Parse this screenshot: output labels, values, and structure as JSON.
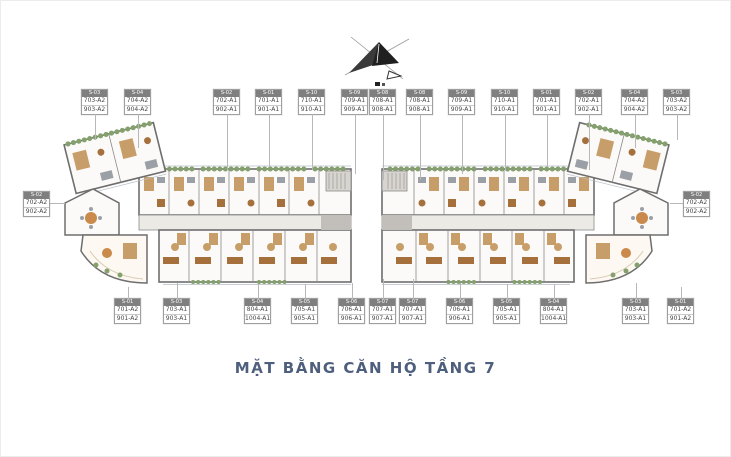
{
  "title": {
    "text": "MẶT BẰNG CĂN HỘ TẦNG 7",
    "color": "#4e5f7e"
  },
  "compass": {
    "meaning": "north-direction-arrow"
  },
  "colors": {
    "wall": "#6e6e6e",
    "floor": "#fbfaf8",
    "corridor": "#eceae5",
    "balcony_green": "#84a06d",
    "wood_tan": "#c79e69",
    "wood_brown": "#a6703d",
    "accent_orange": "#c98a4b",
    "label_header_bg": "#7f7f7f",
    "leader_line": "#b8b8b8",
    "title_blue": "#4e5f7e"
  },
  "unit_labels": {
    "top_left": [
      {
        "header": "S-03",
        "line1": "703-A2",
        "line2": "903-A2",
        "x": 80,
        "lead": 26
      },
      {
        "header": "S-04",
        "line1": "704-A2",
        "line2": "904-A2",
        "x": 123,
        "lead": 34
      },
      {
        "header": "S-02",
        "line1": "702-A1",
        "line2": "902-A1",
        "x": 212,
        "lead": 56
      },
      {
        "header": "S-01",
        "line1": "701-A1",
        "line2": "901-A1",
        "x": 254,
        "lead": 53
      },
      {
        "header": "S-10",
        "line1": "710-A1",
        "line2": "910-A1",
        "x": 297,
        "lead": 56
      },
      {
        "header": "S-09",
        "line1": "709-A1",
        "line2": "909-A1",
        "x": 340,
        "lead": 60
      },
      {
        "header": "S-08",
        "line1": "708-A1",
        "line2": "908-A1",
        "x": 368,
        "lead": 66
      }
    ],
    "top_right": [
      {
        "header": "S-08",
        "line1": "708-A1",
        "line2": "908-A1",
        "x": 405,
        "lead": 66
      },
      {
        "header": "S-09",
        "line1": "709-A1",
        "line2": "909-A1",
        "x": 447,
        "lead": 60
      },
      {
        "header": "S-10",
        "line1": "710-A1",
        "line2": "910-A1",
        "x": 490,
        "lead": 56
      },
      {
        "header": "S-01",
        "line1": "701-A1",
        "line2": "901-A1",
        "x": 532,
        "lead": 53
      },
      {
        "header": "S-02",
        "line1": "702-A1",
        "line2": "902-A1",
        "x": 574,
        "lead": 56
      },
      {
        "header": "S-04",
        "line1": "704-A2",
        "line2": "904-A2",
        "x": 620,
        "lead": 34
      },
      {
        "header": "S-03",
        "line1": "703-A2",
        "line2": "903-A2",
        "x": 662,
        "lead": 26
      }
    ],
    "bottom_left": [
      {
        "header": "S-01",
        "line1": "701-A2",
        "line2": "901-A2",
        "x": 113,
        "lead": 12
      },
      {
        "header": "S-03",
        "line1": "703-A1",
        "line2": "903-A1",
        "x": 162,
        "lead": 16
      },
      {
        "header": "S-04",
        "line1": "804-A1",
        "line2": "1004-A1",
        "x": 243,
        "lead": 15
      },
      {
        "header": "S-05",
        "line1": "705-A1",
        "line2": "905-A1",
        "x": 290,
        "lead": 15
      },
      {
        "header": "S-06",
        "line1": "706-A1",
        "line2": "906-A1",
        "x": 337,
        "lead": 16
      },
      {
        "header": "S-07",
        "line1": "707-A1",
        "line2": "907-A1",
        "x": 368,
        "lead": 20
      }
    ],
    "bottom_right": [
      {
        "header": "S-07",
        "line1": "707-A1",
        "line2": "907-A1",
        "x": 398,
        "lead": 20
      },
      {
        "header": "S-06",
        "line1": "706-A1",
        "line2": "906-A1",
        "x": 445,
        "lead": 16
      },
      {
        "header": "S-05",
        "line1": "705-A1",
        "line2": "905-A1",
        "x": 492,
        "lead": 15
      },
      {
        "header": "S-04",
        "line1": "804-A1",
        "line2": "1004-A1",
        "x": 539,
        "lead": 15
      },
      {
        "header": "S-03",
        "line1": "703-A1",
        "line2": "903-A1",
        "x": 621,
        "lead": 16
      },
      {
        "header": "S-01",
        "line1": "701-A2",
        "line2": "901-A2",
        "x": 666,
        "lead": 12
      }
    ],
    "side_left": {
      "header": "S-02",
      "line1": "702-A2",
      "line2": "902-A2"
    },
    "side_right": {
      "header": "S-02",
      "line1": "702-A2",
      "line2": "902-A2"
    }
  }
}
